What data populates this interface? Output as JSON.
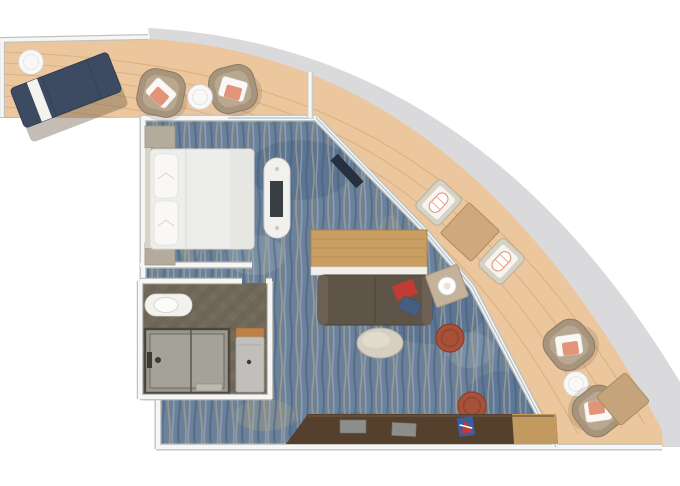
{
  "meta": {
    "kind": "floor-plan",
    "subject": "Top-down rendered floor plan of a cruise-ship balcony suite on a curved hull corner",
    "canvas": {
      "width": 680,
      "height": 486
    }
  },
  "rooms": [
    {
      "id": "bedroom",
      "label": "Bedroom"
    },
    {
      "id": "bathroom",
      "label": "Bathroom"
    },
    {
      "id": "living-area",
      "label": "Living / Dining Area"
    },
    {
      "id": "balcony",
      "label": "Wrap-around Balcony"
    }
  ],
  "furniture": {
    "bedroom": [
      "double bed with two pillows",
      "two nightstands",
      "freestanding TV console",
      "corner media panel"
    ],
    "bathroom": [
      "vanity with basin",
      "walk-in shower",
      "toilet unit with wood shelf"
    ],
    "living": [
      "wood table",
      "dark sofa with two accent pillows",
      "lamp side table",
      "oval coffee table",
      "two rust lounge chairs",
      "long walnut credenza with trays and art piece"
    ],
    "balcony": [
      "navy sun lounger with towel",
      "four tan armchairs with coral pillows",
      "three round side tables",
      "two deck dining chairs with rolled towels",
      "square deck table",
      "square side table",
      "balcony divider"
    ]
  },
  "colors": {
    "hull": "#dadadc",
    "deck": "#ecc69c",
    "plank": "#d8ae81",
    "wall": "#f6f6f5",
    "wall_edge": "#c2c2c0",
    "glass": "#a9c3cf",
    "carpet": "#6d8299",
    "carpet_navy": "#3a5a82",
    "carpet_tan": "#c4b083",
    "carpet_light": "#a8b6c0",
    "tile": "#746c5c",
    "tile_stripe": "#675f50",
    "shower": "#9b978e",
    "shower_inner": "#a5a29a",
    "fixture": "#3c3a33",
    "white_furniture": "#f2f1ed",
    "duvet": "#edeeec",
    "pillow": "#f9f8f6",
    "nightstand": "#b5ab9c",
    "wood": "#c89e62",
    "wood_dark": "#ab8248",
    "ledge": "#f0efeb",
    "sofa": "#5f5448",
    "sofa_arm": "#6b6053",
    "credenza": "#54402d",
    "credenza_light": "#c2995f",
    "tray": "#8d8d89",
    "art_blue": "#3a5da0",
    "art_red": "#c03b30",
    "rust": "#a85138",
    "coral": "#e39478",
    "lounger_navy": "#3c4b61",
    "towel": "#f4f3f0",
    "chair_tan": "#a7947c",
    "chair_cushion": "#b9a88f",
    "deckchair_frame": "#d6d2c4",
    "deckchair_cushion": "#f6f4ef",
    "deck_table": "#cfa87e",
    "side_table_sq": "#c6a47b",
    "lamp_table": "#c4b29c",
    "coffee_table": "#d7d0c2",
    "toilet_body": "#c0bfbb",
    "toilet_wood": "#bd8046",
    "tv": "#3a3f45",
    "media_panel": "#26303f",
    "shadow": "#6b5b45"
  }
}
